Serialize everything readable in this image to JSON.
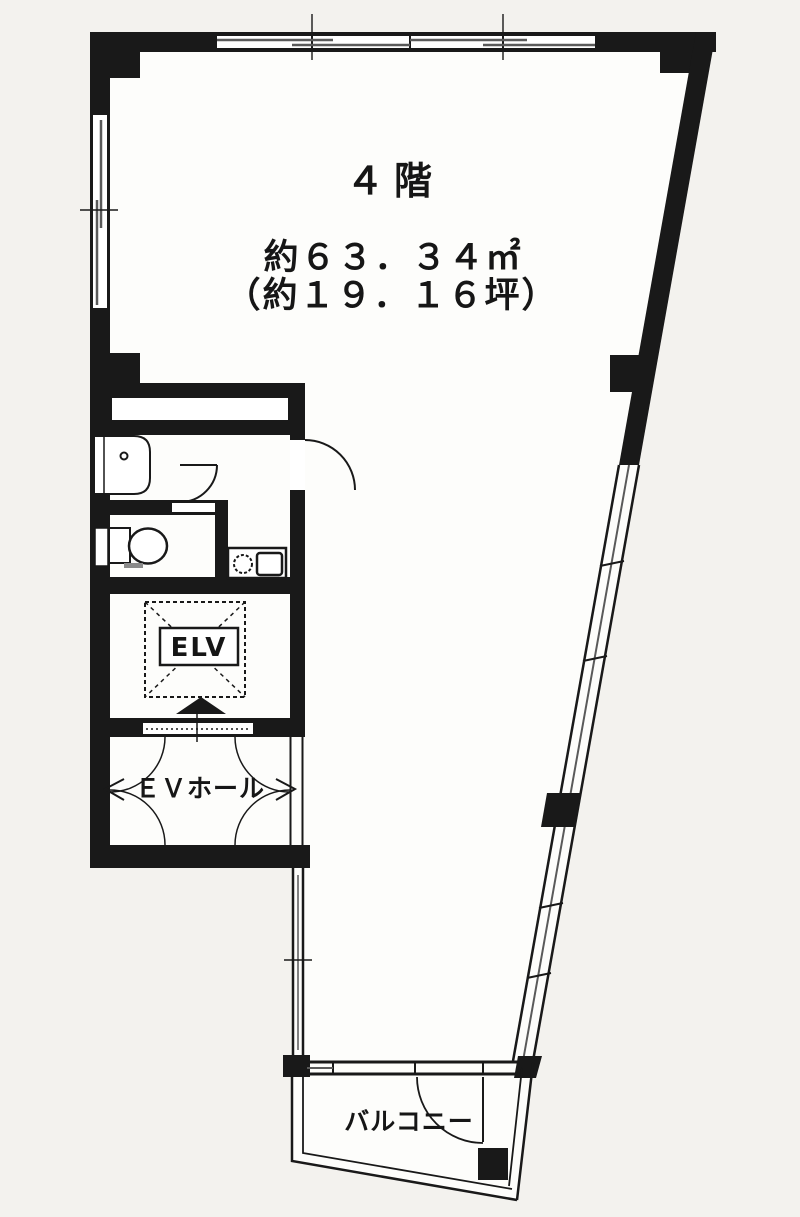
{
  "floor_plan": {
    "floor_title": "４階",
    "area_m2": "約６３．３４㎡",
    "area_tsubo": "（約１９．１６坪）",
    "rooms": {
      "elevator_label": "ELV",
      "ev_hall_label": "ＥＶホール",
      "balcony_label": "バルコニー"
    },
    "colors": {
      "wall": "#191919",
      "paper": "#f3f2ee",
      "floor": "#fdfdfb",
      "sash_gray": "#5a5a5a"
    },
    "icons": [
      "toilet-icon",
      "vanity-sink-icon",
      "kitchen-sink-icon",
      "elevator-arrow-icon",
      "door-swing-arc",
      "window-sash-lines"
    ]
  }
}
